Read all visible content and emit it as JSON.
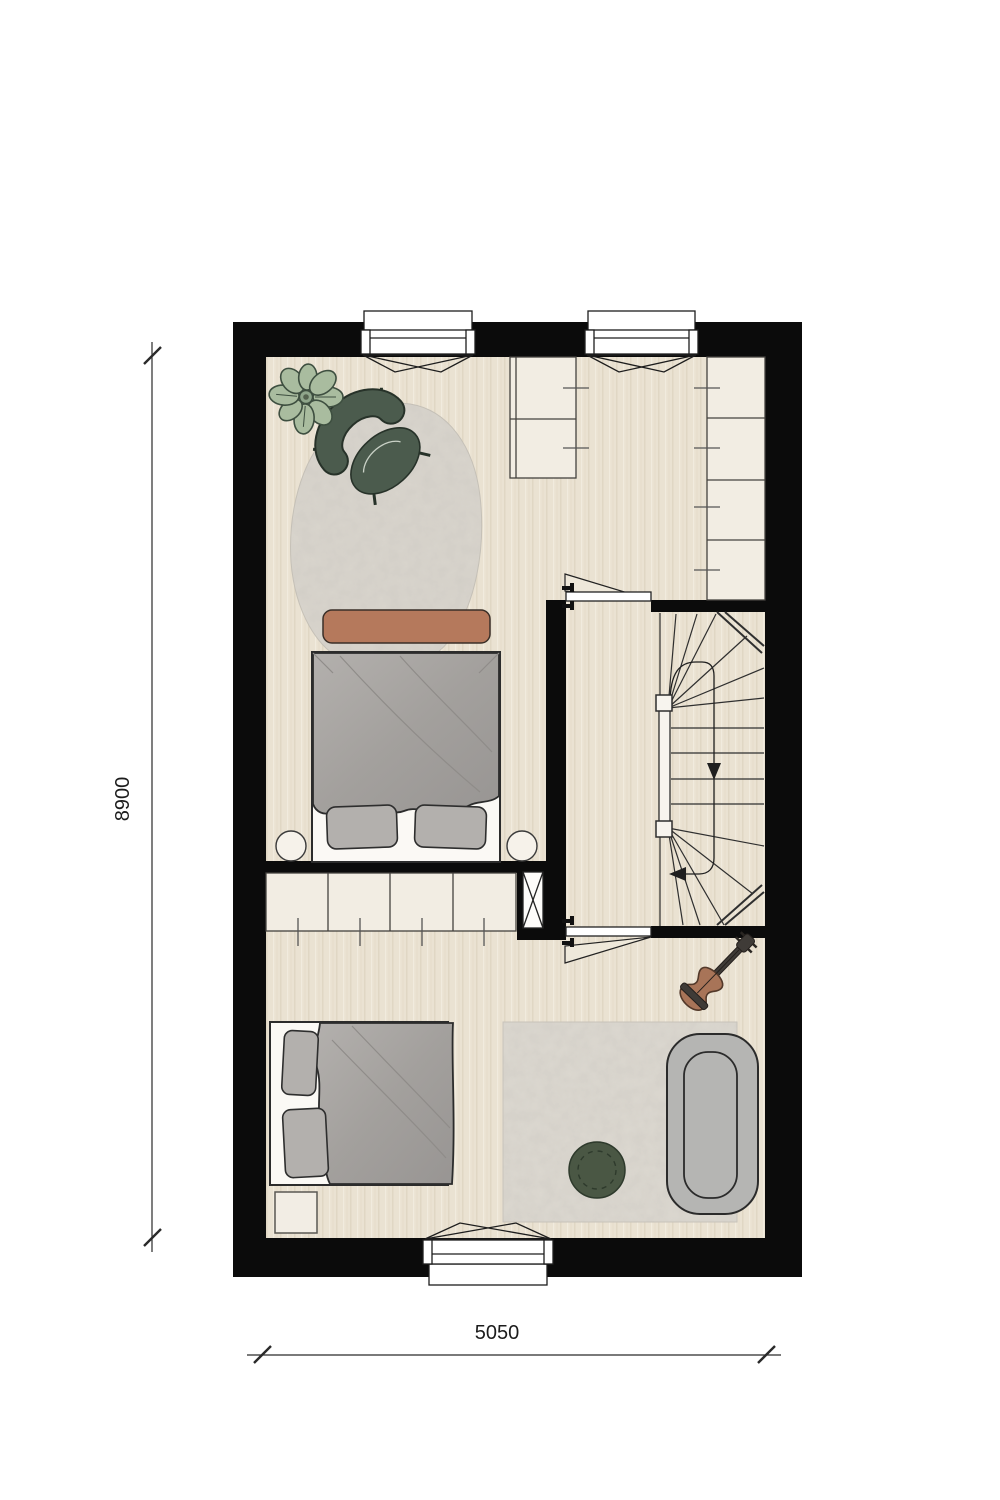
{
  "plan": {
    "title": "floor-plan-upper-storey",
    "scale_labels": {
      "vertical": "8900",
      "horizontal": "5050"
    },
    "windows_count": 3,
    "doors_count": 2,
    "rooms": [
      {
        "name": "bedroom-1",
        "furniture": [
          "potted-plant",
          "armchair",
          "organic-rug",
          "bench",
          "double-bed",
          "nightstand-left",
          "nightstand-right",
          "built-in-closet-mid",
          "built-in-closet-right",
          "wardrobe"
        ]
      },
      {
        "name": "landing",
        "furniture": [
          "winder-staircase",
          "stair-railing",
          "door-to-bedroom-1",
          "door-to-bedroom-2",
          "duct-shaft"
        ]
      },
      {
        "name": "bedroom-2",
        "furniture": [
          "double-bed",
          "side-table",
          "rect-rug",
          "pouf",
          "sofa",
          "acoustic-guitar"
        ]
      }
    ]
  },
  "palette": {
    "wall": "#0b0b0b",
    "floor": "#eae2d2",
    "floor_grain": "#dcd2bf",
    "cabinet": "#f2ede3",
    "outline": "#2c2c2c",
    "rug": "#d9d5cd",
    "bed_duvet": "#a6a3a0",
    "bed_pillow": "#b3b0ad",
    "bench": "#b5795c",
    "accent_green": "#4b5b4d",
    "plant_leaf": "#a9bc9f",
    "sofa": "#b5b5b3",
    "guitar_body": "#a87458",
    "paper": "#ffffff"
  }
}
